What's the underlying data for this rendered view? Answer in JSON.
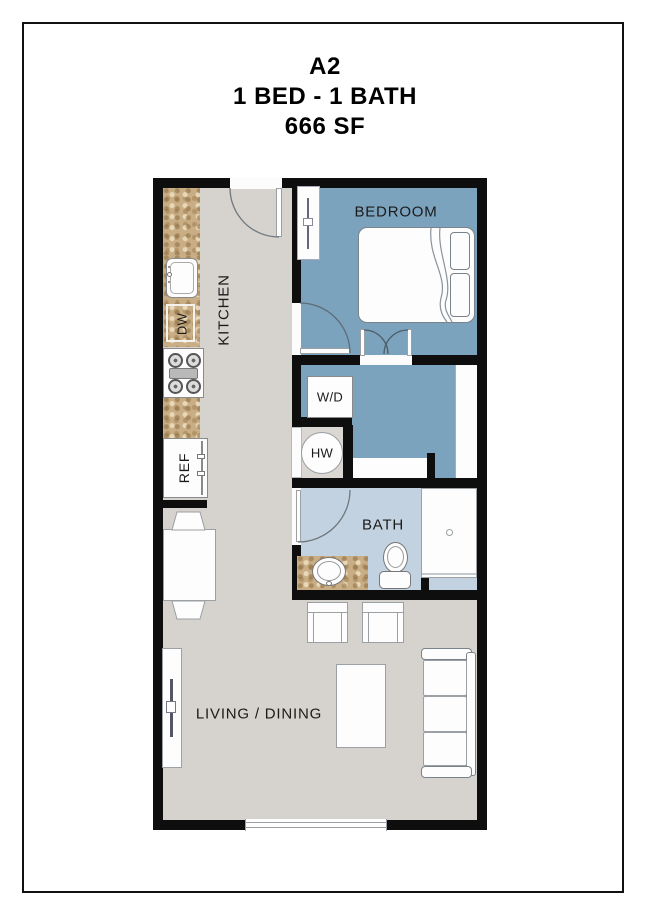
{
  "title": {
    "plan_code": "A2",
    "beds_baths": "1 BED - 1 BATH",
    "area": "666 SF"
  },
  "rooms": {
    "kitchen": "KITCHEN",
    "bedroom": "BEDROOM",
    "bath": "BATH",
    "living_dining": "LIVING / DINING",
    "washer_dryer": "W/D",
    "water_heater": "HW"
  },
  "appliances": {
    "dishwasher": "DW",
    "refrigerator": "REF"
  },
  "colors": {
    "wall": "#0e0e0e",
    "floor_gray": "#d6d2cd",
    "bedroom_blue": "#7ca3bd",
    "bath_blue": "#c3d2e0",
    "granite_tan": "#c9ad84",
    "label_text": "#1b1b1b",
    "line_gray": "#8a8a8a",
    "arc_gray": "#70787f",
    "frame_black": "#111111"
  }
}
